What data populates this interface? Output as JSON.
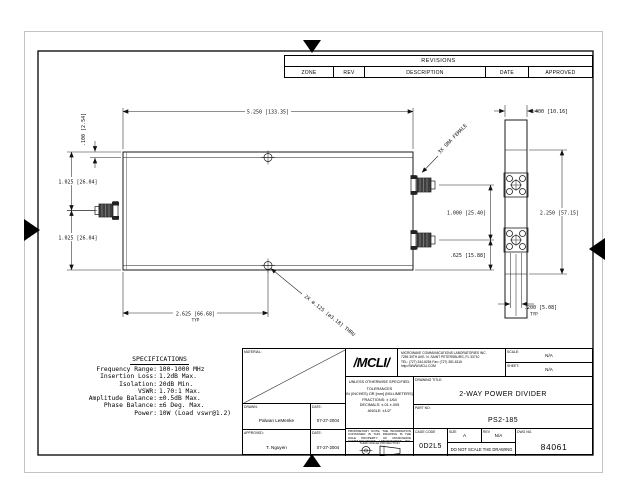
{
  "revisions": {
    "title": "REVISIONS",
    "columns": [
      "ZONE",
      "REV",
      "DESCRIPTION",
      "DATE",
      "APPROVED"
    ]
  },
  "drawing": {
    "dims": {
      "width_top": "5.250 [133.35]",
      "offset_top": ".100 [2.54]",
      "height_upper": "1.025 [26.04]",
      "height_lower": "1.025 [26.04]",
      "port_spacing": "1.000 [25.40]",
      "port_offset": ".625 [15.88]",
      "end_width": ".400 [10.16]",
      "end_height": "2.250 [57.15]",
      "hole_pitch": ".200 [5.08]",
      "hole_pitch_typ": "TYP",
      "mount_spacing": "2.625 [66.68]",
      "mount_spacing_typ": "TYP",
      "mount_hole_callout": "2X ø.125 [ø3.18] THRU",
      "connector_callout": "3X SMA FEMALE"
    }
  },
  "specifications": {
    "title": "SPECIFICATIONS",
    "items": [
      {
        "label": "Frequency Range:",
        "value": "100-1000 MHz"
      },
      {
        "label": "Insertion Loss:",
        "value": "1.2dB Max."
      },
      {
        "label": "Isolation:",
        "value": "20dB Min."
      },
      {
        "label": "VSWR:",
        "value": "1.70:1 Max."
      },
      {
        "label": "Amplitude Balance:",
        "value": "±0.5dB Max."
      },
      {
        "label": "Phase Balance:",
        "value": "±6 Deg. Max."
      },
      {
        "label": "Power:",
        "value": "10W (Load vswr@1.2)"
      }
    ]
  },
  "title_block": {
    "material_label": "MATERIAL:",
    "drawn_label": "DRAWN:",
    "drawn_name": "Palwan LeMenke",
    "drawn_date_label": "DATE:",
    "drawn_date": "07-27-2004",
    "approved_label": "APPROVED:",
    "approved_name": "T. Nguyen",
    "approved_date_label": "DATE:",
    "approved_date": "07-27-2004",
    "company": {
      "logo": "/MCLI/",
      "lines": [
        "MICROWAVE COMMUNICATIONS LABORATORIES INC.",
        "7255 30TH AVE. N. SAINT PETERSBURG, FL 33710",
        "TEL: (727) 344-6254   Fax: (727) 381-6116",
        "http://WWW.MCLI.COM"
      ]
    },
    "scale_label": "SCALE:",
    "scale_value": "N/A",
    "sheet_label": "SHEET:",
    "sheet_value": "N/A",
    "tolerances": [
      "UNLESS OTHERWISE SPECIFIED:",
      "TOLERANCES",
      "IN (INCHES) OR [mm] (MILLIMETERS)",
      "FRACTIONS: ± 1/64",
      "DECIMALS: ±.01 ±.005",
      "ANGLE: ±1/2°"
    ],
    "drawing_title_label": "DRAWING TITLE:",
    "drawing_title": "2-WAY POWER DIVIDER",
    "part_no_label": "PART NO:",
    "part_no": "PS2-185",
    "proprietary_note": "PROPRIETARY NOTE: THE INFORMATION CONTAINED IN THIS DRAWING IS THE SOLE PROPERTY OF MICROWAVE COMMUNICATIONS LABORATORIES INC. ANY REPRODUCTION IN PART OR AS A WHOLE WITHOUT WRITTEN PERMISSION IS PROHIBITED.",
    "projection_label": "THIRD ANGLE PROJECTION",
    "cage_label": "CAGE CODE",
    "cage_value": "0D2L5",
    "size_label": "SIZE",
    "size_value": "A",
    "rev_label": "REV",
    "rev_value": "N/A",
    "dwg_label": "DWG NO.",
    "dwg_value": "84061",
    "do_not_scale": "DO NOT SCALE THE DRAWING"
  }
}
